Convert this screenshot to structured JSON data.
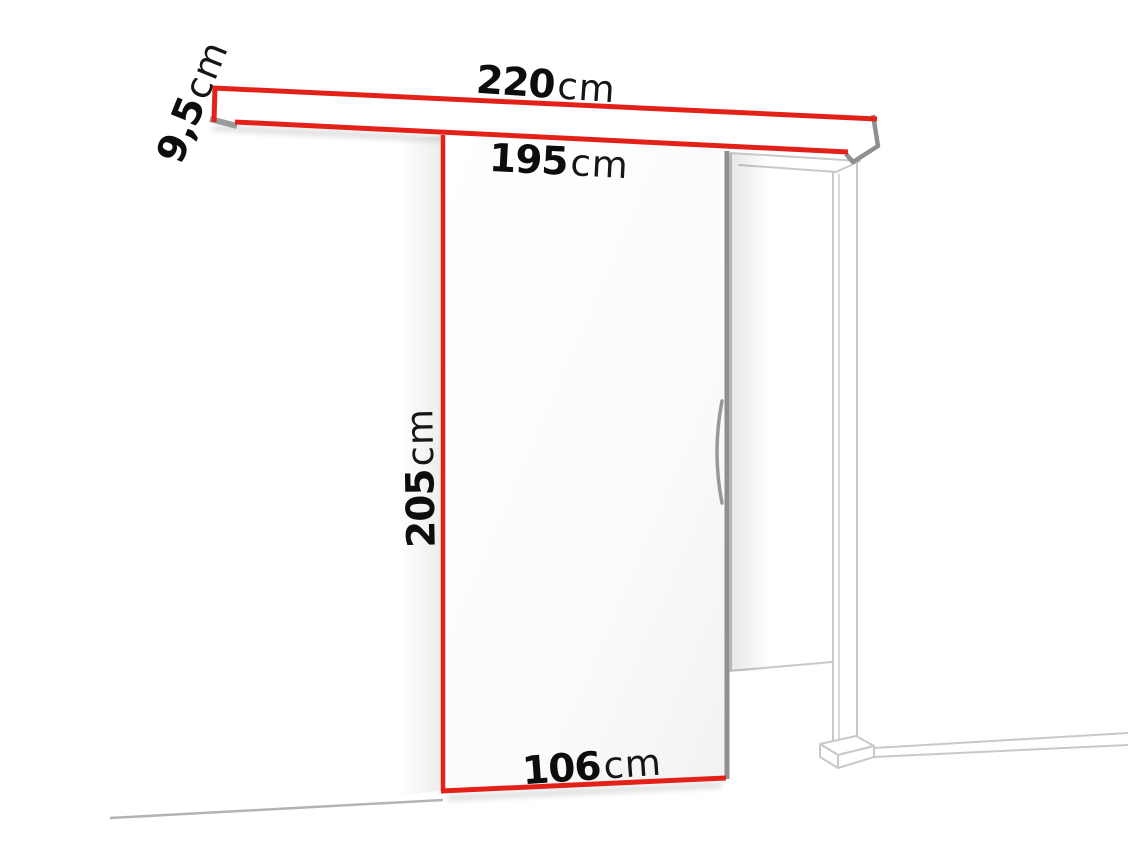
{
  "diagram": {
    "kind": "sliding-door-dimension-diagram",
    "colors": {
      "dimension_red": "#e32119",
      "edge_gray": "#8f8f8f",
      "frame_gray": "#c9c9c9",
      "floor_gray": "#b3b3b3",
      "cap_gray": "#9a9a9a",
      "handle_gray": "#999999"
    },
    "dimensions": {
      "rail_length": {
        "value": "220",
        "unit": "cm"
      },
      "clear_width": {
        "value": "195",
        "unit": "cm"
      },
      "rail_height": {
        "value": "9,5",
        "unit": "cm"
      },
      "door_height": {
        "value": "205",
        "unit": "cm"
      },
      "door_width": {
        "value": "106",
        "unit": "cm"
      }
    }
  }
}
